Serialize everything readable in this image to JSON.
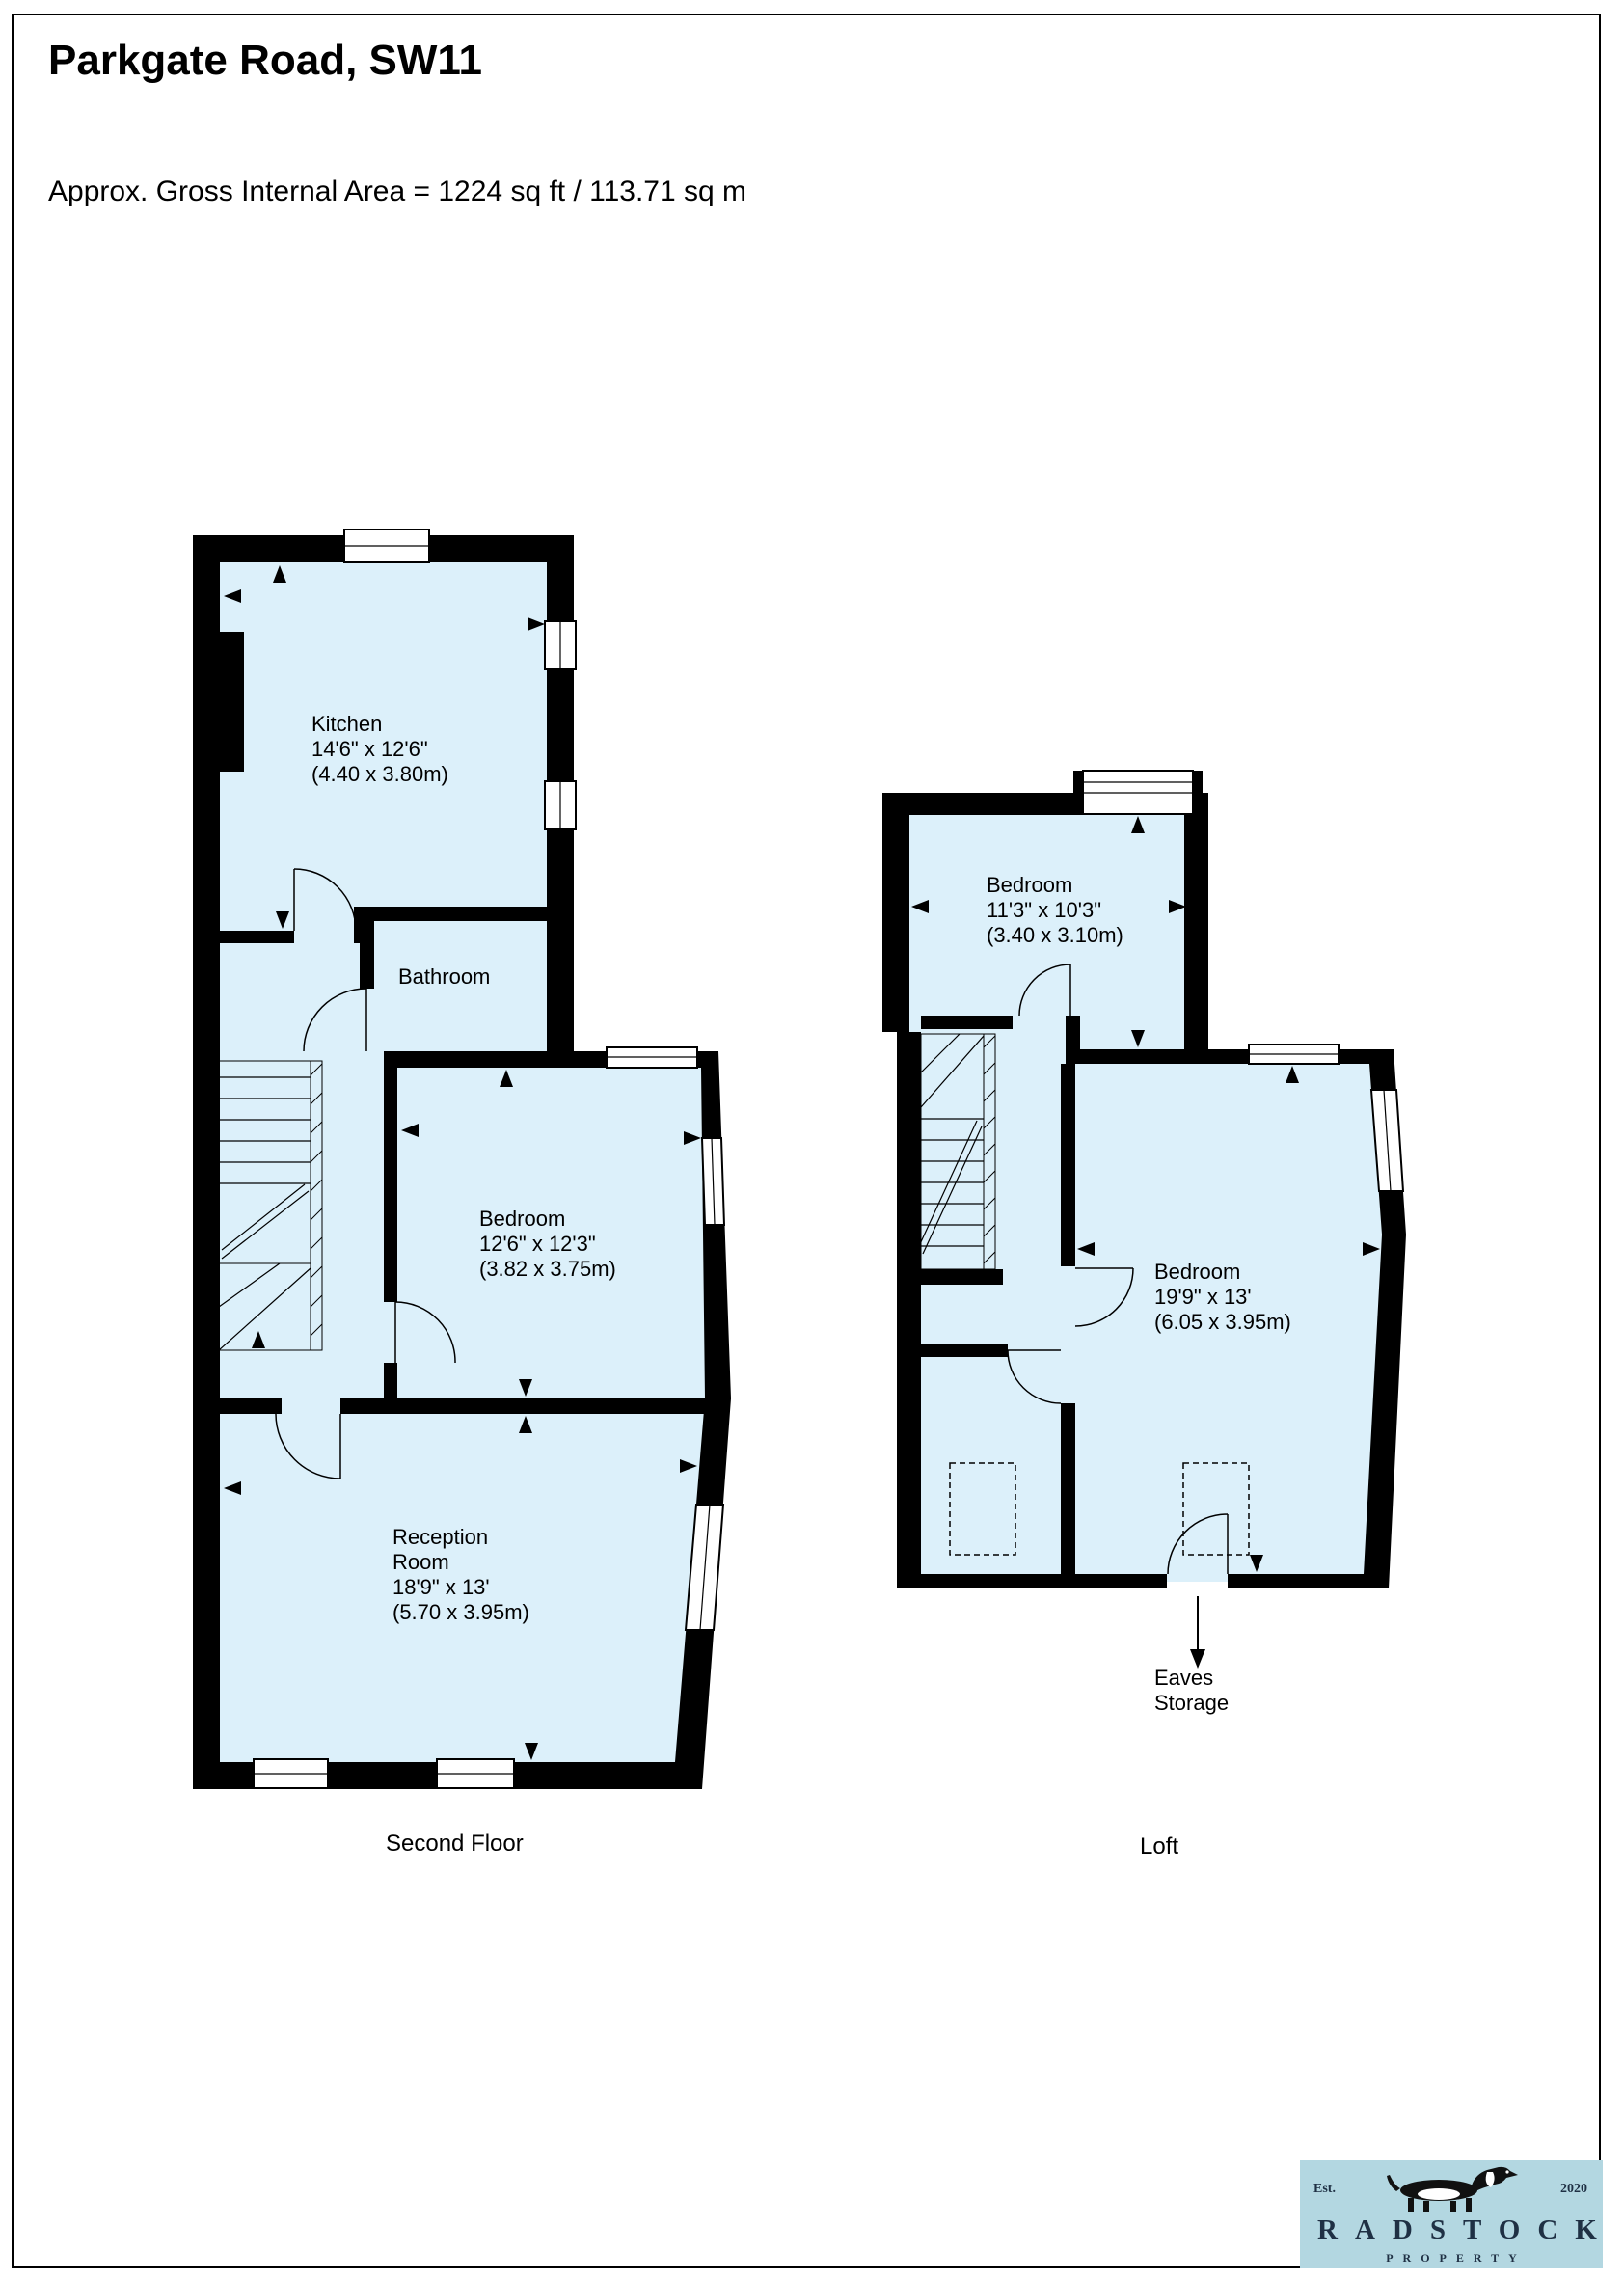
{
  "page": {
    "title": "Parkgate Road, SW11",
    "subtitle": "Approx. Gross Internal Area = 1224 sq ft  /  113.71 sq m"
  },
  "floors": {
    "second": {
      "label": "Second Floor",
      "rooms": {
        "kitchen": {
          "name": "Kitchen",
          "dims_ft": "14'6\" x 12'6\"",
          "dims_m": "(4.40 x 3.80m)"
        },
        "bathroom": {
          "name": "Bathroom"
        },
        "bedroom": {
          "name": "Bedroom",
          "dims_ft": "12'6\" x 12'3\"",
          "dims_m": "(3.82 x 3.75m)"
        },
        "reception": {
          "name_line1": "Reception",
          "name_line2": "Room",
          "dims_ft": "18'9\" x 13'",
          "dims_m": "(5.70 x 3.95m)"
        }
      }
    },
    "loft": {
      "label": "Loft",
      "rooms": {
        "bedroom_small": {
          "name": "Bedroom",
          "dims_ft": "11'3\" x 10'3\"",
          "dims_m": "(3.40 x 3.10m)"
        },
        "bedroom_large": {
          "name": "Bedroom",
          "dims_ft": "19'9\" x 13'",
          "dims_m": "(6.05 x 3.95m)"
        },
        "eaves": {
          "line1": "Eaves",
          "line2": "Storage"
        }
      }
    }
  },
  "logo": {
    "est": "Est.",
    "year": "2020",
    "brand": "RADSTOCK",
    "tagline": "PROPERTY"
  },
  "colors": {
    "room_fill": "#dcf0fa",
    "wall": "#000000",
    "logo_bg": "#b3d7e1",
    "logo_text": "#1f3044"
  }
}
